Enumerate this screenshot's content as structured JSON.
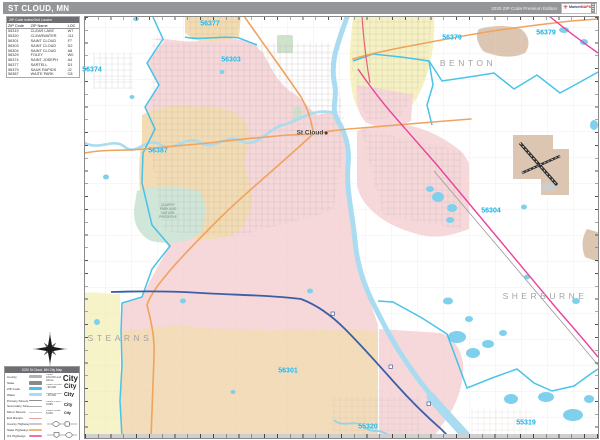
{
  "page": {
    "title": "ST CLOUD, MN",
    "edition": "2020 ZIP Code Premium Edition",
    "logo": {
      "brand": "Market",
      "brand2": "MAPS"
    }
  },
  "zip_table": {
    "title": "ZIP Code Index/Grid Locator",
    "columns": [
      "ZIP Code",
      "ZIP Name",
      "LOC"
    ],
    "rows": [
      [
        "55319",
        "CLEAR LAKE",
        "W7"
      ],
      [
        "55320",
        "CLEARWATER",
        "J11"
      ],
      [
        "56301",
        "SAINT CLOUD",
        "F7"
      ],
      [
        "56303",
        "SAINT CLOUD",
        "D2"
      ],
      [
        "56304",
        "SAINT CLOUD",
        "A8"
      ],
      [
        "56329",
        "FOLEY",
        "W0"
      ],
      [
        "56374",
        "SAINT JOSEPH",
        "A4"
      ],
      [
        "56377",
        "SARTELL",
        "D1"
      ],
      [
        "56379",
        "SAUK RAPIDS",
        "J2"
      ],
      [
        "56387",
        "WAITE PARK",
        "C8"
      ]
    ]
  },
  "legend": {
    "title": "2020 St Cloud, MN City Map",
    "items": [
      {
        "label": "County",
        "color": "#b3b3b3",
        "h": 3
      },
      {
        "label": "State",
        "color": "#8a8a8a",
        "h": 3.6
      },
      {
        "label": "ZIP Code",
        "color": "#45c2e8",
        "h": 2.6
      },
      {
        "label": "Water",
        "color": "#a9dcf0",
        "h": 2.6
      },
      {
        "label": "Primary Streets",
        "color": "#8f8f8f",
        "h": 1.6
      },
      {
        "label": "Secondary Streets",
        "color": "#ababab",
        "h": 1.2
      },
      {
        "label": "Minor Streets",
        "color": "#cccccc",
        "h": 1
      },
      {
        "label": "Exit Ramps",
        "color": "#e8a0a8",
        "h": 1.2
      },
      {
        "label": "County Highways",
        "color": "#c9c9c9",
        "h": 1.8
      },
      {
        "label": "State Highways",
        "color": "#f2b576",
        "h": 2
      },
      {
        "label": "US Highways",
        "color": "#ee6fae",
        "h": 2
      },
      {
        "label": "Interstate Highways",
        "color": "#7ea6d8",
        "h": 2.4
      },
      {
        "label": "Toll Roads",
        "color": "#8fce8f",
        "h": 2.2
      }
    ],
    "city_classes": [
      {
        "label": "Cities 100,000 and Above",
        "sample": "City",
        "size": 8
      },
      {
        "label": "Cities 50,000 - 99,999",
        "sample": "City",
        "size": 6.6
      },
      {
        "label": "Cities 10,000 - 49,999",
        "sample": "City",
        "size": 5.4
      },
      {
        "label": "Cities 5,000 - 9,999",
        "sample": "City",
        "size": 4.4
      },
      {
        "label": "Cities Under 5,000",
        "sample": "City",
        "size": 3.6
      }
    ]
  },
  "map": {
    "zip_labels": [
      {
        "text": "56377",
        "x": 210,
        "y": 24
      },
      {
        "text": "56303",
        "x": 231,
        "y": 60
      },
      {
        "text": "56374",
        "x": 92,
        "y": 70
      },
      {
        "text": "56387",
        "x": 158,
        "y": 151
      },
      {
        "text": "56379",
        "x": 452,
        "y": 38
      },
      {
        "text": "56379",
        "x": 546,
        "y": 33
      },
      {
        "text": "56304",
        "x": 491,
        "y": 211
      },
      {
        "text": "56301",
        "x": 288,
        "y": 371
      },
      {
        "text": "55320",
        "x": 368,
        "y": 427
      },
      {
        "text": "55319",
        "x": 526,
        "y": 423
      }
    ],
    "county_labels": [
      {
        "text": "BENTON",
        "x": 468,
        "y": 63
      },
      {
        "text": "SHERBURNE",
        "x": 545,
        "y": 296
      },
      {
        "text": "STEARNS",
        "x": 120,
        "y": 338
      }
    ],
    "city_labels": [
      {
        "text": "St Cloud",
        "x": 312,
        "y": 133
      }
    ],
    "poi_labels": [
      {
        "lines": [
          "QUARRY",
          "PARK AND",
          "NATURE",
          "PRESERVE"
        ],
        "x": 168,
        "y": 212
      }
    ],
    "colors": {
      "zip_label": "#14b2e8",
      "zip_boundary": "#3fc0e8",
      "water": "#a9dcf0",
      "urban_pink": "#f6d7da",
      "urban_tan": "#f3dcb4",
      "urban_yellow": "#f5f1c2",
      "state_highway": "#f0a35e",
      "us_highway": "#e8459a",
      "interstate": "#3a5fa8"
    }
  }
}
